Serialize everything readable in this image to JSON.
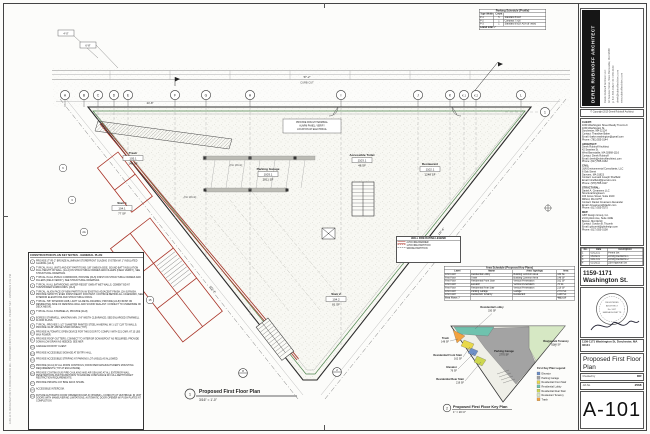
{
  "sheet": {
    "edge_note": "1159-1171 WASHINGTON ST, DORCHESTER MA - PROPOSED FIRST FLOOR PLAN - PERMIT SET - 10/05/2023 2:41 PM",
    "accent_red": "#a83226",
    "accent_green": "#3f7a3f"
  },
  "key_notes": {
    "title": "CONSTRUCTION PLAN KEY NOTES - GENERAL PLAN",
    "items": [
      {
        "n": "1",
        "text": "PROVIDE (TYP) 2\" BRONZE ALUMINUM STOREFRONT GLAZING SYSTEM W/ 1\" INSULATED GLAZING. [2A-3]"
      },
      {
        "n": "2",
        "text": "TYPICAL IN ALL UNITS AND EXT PARTITIONS: 5/8\" GWB EA SIDE, SOUND BATT INSULATION FULL HEIGHT OF WALL. [1A-4] ON STRUCTURAL FRAMES AND FILLERS (FIELD VERIFY), SEE STRUCTURAL DRAWINGS."
      },
      {
        "n": "3",
        "text": "TYPICAL IN ALL PUBLIC CORRIDORS, PROVIDE [3A-5] FINISH ON STRUCTURAL FRAMES AND FILLERS (FIELD VERIFY), SEE STRUCTURAL DRAWINGS."
      },
      {
        "n": "4",
        "text": "TYPICAL IN ALL BATHROOMS: WATER-RESIST GWB AT WET WALLS, CEMENT BD AT TUB/SHOWER SURROUNDS. [2A-6]"
      },
      {
        "n": "5",
        "text": "TYPICAL: ALIGN FACE OF NEW PARTITION W/ EXISTING ADJACENT FINISH. [2A-3] FINISH. PROVIDE SMOOTH, EVEN FINISH READY FOR PAINT. CONTINUE BEHIND ALL CASEWORK, SEE INTERIOR ELEVATIONS AND STRUCTURAL DWGS."
      },
      {
        "n": "6",
        "text": "TYPICAL: 5/8\" INTERIOR GWB, LIGHT GA METAL FRAMING; PROVIDE [2A-8] FINISH ON RESIDENTIAL SIDE OF DEMISING WALL AND SOUND SEALANT. CONNECT TO UNDERSIDE OF DECK ABOVE."
      },
      {
        "n": "7",
        "text": "TYPICAL IN ALL STAIRWELLS, PROVIDE [2A-8]."
      },
      {
        "n": "8",
        "text": "EGRESS STAIRWELL, MAINTAIN MIN. 3'-8\" WIDTH CLEARANCE; SEE ENLARGED STAIRWELL FLOOR PLANS."
      },
      {
        "n": "9",
        "text": "TYPICAL: PROVIDE 1-1/2\" DIAMETER PAINTED STEEL HANDRAIL W/ 1-1/2\" CLR TO WALLS; PROVIDE 34-36\" ABOVE STAIR NOSING (TYP)."
      },
      {
        "n": "10",
        "text": "PROVIDE AUTOMATIC OPEN DEVICE FOR THIS DOOR TO COMPLY WITH 521 CMR; AT 15 LBS MAX POWER."
      },
      {
        "n": "11",
        "text": "PROVIDE ROOF GUTTERS; CONNECT TO INTERIOR DOWNSPOUT AS REQUIRED; PROVIDE DOWN-LOW DRAIN AS NEEDED; SEE MEP."
      },
      {
        "n": "12",
        "text": "GARAGE DOOR BY CLIENT."
      },
      {
        "n": "13",
        "text": "PROVIDE ACCESSIBLE SIGNAGE AT ENTRY HALL."
      },
      {
        "n": "14",
        "text": "PROVIDE ACCESSIBLE STRIPING AT PARKING LOT (AISLE) AS ALLOWED."
      },
      {
        "n": "15",
        "text": "PROVIDE [10-11] AT ALL ROOM CONTROLS; ROOM PER MANUFACTURER'S MOUNTING REQUIREMENTS (TYP AT ENCLOSURE)."
      },
      {
        "n": "16",
        "text": "PROVIDE CONTINUOUS FIRE CAULKING AND AIR SEALING AT ALL EXTERIOR WALL PENETRATIONS AND TRANSITIONS TO ENSURE COMPLIANCE W/ FULL-DEPTH DRAFT RESTRICTION REQUIREMENTS."
      },
      {
        "n": "17",
        "text": "PROVIDE PRIVATE 4'x6' BIKE RACK SHAPE."
      },
      {
        "n": "18",
        "text": "ACCESSIBLE INTERCOM."
      },
      {
        "n": "19",
        "text": "FUTURE AUTOMATIC DOOR OPENER ROUGH-IN (POWER + CONDUIT) AT VESTIBULE; IN UNIT DOORS WITH MANEUVERING LIMITATIONS, AUTOMATIC DOOR OPENER W/ PUSH PLATES AT COMPLETION."
      }
    ]
  },
  "parking_schedule": {
    "title": "Parking Schedule (Profile)",
    "columns": [
      "Type Width",
      "Count",
      ""
    ],
    "rows": [
      [
        "P-1",
        "5",
        "Standard 8'x18'"
      ],
      [
        "P-2",
        "1",
        "Compact 7'x16'"
      ],
      [
        "P-3",
        "1",
        "Standard 8'x18' ADA (8' wide)"
      ]
    ],
    "footer": "Grand total: 7"
  },
  "grid": {
    "letters": [
      "A",
      "B",
      "C",
      "D",
      "E",
      "F",
      "G",
      "H",
      "I",
      "J",
      "K",
      "K.1",
      "K.2",
      "L"
    ],
    "row_bubble": "1"
  },
  "plan": {
    "street_label_dim": "57'-2\"",
    "street_label": "CURB CUT",
    "top_dim": "24'-8\"",
    "left_dim": "121'-4\"",
    "right_dim": "137'-6\"",
    "detail_dims": [
      "4'-0\"",
      "6'-8\""
    ],
    "keyed_bubbles": [
      "6",
      "3",
      "2A",
      "15"
    ],
    "no_work": "(No Work)",
    "note_box_lines": [
      "PROVIDE ROUGH TERMINAL",
      "ALARM PANEL; VERIFY",
      "LOCATION W/ ELECTRICAL"
    ],
    "rooms": [
      {
        "name": "Parking Garage",
        "number": "1003.1",
        "area": "2811 SF"
      },
      {
        "name": "Accessible Toilet",
        "number": "1103.1",
        "area": "48 SF"
      },
      {
        "name": "Restaurant",
        "number": "1102.1",
        "area": "1248 SF"
      },
      {
        "name": "Trash",
        "number": "105.1",
        "area": "148 SF"
      },
      {
        "name": "Stair 1",
        "number": "104.1",
        "area": "77 SF"
      },
      {
        "name": "Stair 2",
        "number": "104.2",
        "area": "81 SF"
      }
    ],
    "detail_markers": [
      "2",
      "8"
    ],
    "caption": {
      "num": "1",
      "title": "Proposed First Floor Plan",
      "scale": "3/16\" = 1'-0\""
    }
  },
  "wall_legend": {
    "title": "WALL FIRE RATING LEGEND",
    "rows": [
      {
        "symbol": "double-red",
        "label": "2-HR FIRE BARRIER"
      },
      {
        "symbol": "dash-red",
        "label": "1-HR FIRE PARTITION"
      },
      {
        "symbol": "dash-gray",
        "label": "SMOKE PARTITION"
      }
    ]
  },
  "area_schedule": {
    "title": "Area Schedule (Proposed Key Plans)",
    "columns": [
      "Level",
      "Name",
      "Area Typology",
      "Area"
    ],
    "rows": [
      [
        "First Floor",
        "Residential Lobby",
        "Building Common Area",
        "330 SF"
      ],
      [
        "First Floor",
        "Trash",
        "Building Common Area",
        "148 SF"
      ],
      [
        "First Floor",
        "Residential Front Stair",
        "Vertical Penetration",
        "162 SF"
      ],
      [
        "First Floor",
        "Elevator",
        "Vertical Penetration",
        "76 SF"
      ],
      [
        "First Floor",
        "Residential Rear Stair",
        "Vertical Penetration",
        "219 SF"
      ],
      [
        "First Floor",
        "Parking Garage",
        "Garage",
        "2770 SF"
      ],
      [
        "First Floor",
        "Restaurant Tenancy",
        "Restaurant",
        "1248 SF"
      ]
    ],
    "footer": [
      "First Floor: 7",
      "",
      "",
      "4953 SF"
    ]
  },
  "key_plan": {
    "labels": [
      {
        "name": "Residential Lobby",
        "area": "330 SF"
      },
      {
        "name": "Trash",
        "area": "148 SF"
      },
      {
        "name": "Residential Front Stair",
        "area": "162 SF"
      },
      {
        "name": "Elevator",
        "area": "76 SF"
      },
      {
        "name": "Residential Rear Stair",
        "area": "219 SF"
      },
      {
        "name": "Parking Garage",
        "area": "2770 SF"
      },
      {
        "name": "Restaurant Tenancy",
        "area": "1248 SF"
      }
    ],
    "legend": {
      "title": "First Key Plan Legend",
      "items": [
        {
          "label": "Elevator",
          "color": "#6d8fc7"
        },
        {
          "label": "Parking Garage",
          "color": "#a3a3a3"
        },
        {
          "label": "Residential Front Stair",
          "color": "#e8d84a"
        },
        {
          "label": "Residential Lobby",
          "color": "#6fc2ae"
        },
        {
          "label": "Residential Rear Stair",
          "color": "#cdd74f"
        },
        {
          "label": "Restaurant Tenancy",
          "color": "#d6e8c4"
        },
        {
          "label": "Trash",
          "color": "#f2a23f"
        }
      ]
    },
    "caption": {
      "num": "2",
      "title": "Proposed First Floor Key Plan",
      "scale": "1\" = 20'-0\""
    }
  },
  "titleblock": {
    "firm": {
      "name": "DEREK RUBINOFF ARCHITECT",
      "contact_lines": [
        "Derek Rubinoff Architect LLC",
        "42 Seaview Street, West Barnstable, MA 02668",
        "p: 617.555.0162  f: 617.555.0163",
        "derek@rubinoffarchitect.com",
        "www.rubinoffarchitect.com"
      ]
    },
    "copyright": "© Copyright 2019 Derek Rubinoff Architect",
    "consultants": [
      {
        "header": "CLIENT:",
        "lines": [
          "1159 Washington Street Realty Trust LLC",
          "1159 Washington St.",
          "Dorchester, MA 02124",
          "Contact: Thandiwe Baker",
          "Email: tbaker.washington@gmail.com",
          "Phone: (781) 555-0144"
        ]
      },
      {
        "header": "ARCHITECT:",
        "lines": [
          "Derek Rubinoff Architect",
          "42 Seaview St.",
          "West Barnstable, MA 02668-1116",
          "Contact: Derek Rubinoff",
          "Email: derek@rubinoffarchitect.com",
          "Phone: (617) 555-0162"
        ]
      },
      {
        "header": "CIVIL:",
        "lines": [
          "J&N Environmental Consultants, LLC",
          "8 Oak Street",
          "Danvers, MA 01923",
          "Contact: Leonard Joseph Sheffield",
          "Email: lsheffield@jnenviro.com",
          "Phone: (978) 555-0117"
        ]
      },
      {
        "header": "STRUCTURAL:",
        "lines": [
          "Daniel A. Creamens LLC",
          "Structural Engineers",
          "100 Grove Street, Suite 2100",
          "Milford, MA 01757",
          "Contact: Daniel Creamens Alexander",
          "Email: dcreamens@dacllc.com",
          "Phone: (617) 555-0175"
        ]
      },
      {
        "header": "MEP:",
        "lines": [
          "GBT Design Group, Inc.",
          "21 Drydock Ave, Suite 410E",
          "Boston, MA 02210",
          "Contact: Gordon B. Titcomb",
          "Email: gtitcomb@gbtdesign.com",
          "Phone: (617) 555-0108"
        ]
      }
    ],
    "revisions": {
      "columns": [
        "No.",
        "Date",
        "Description"
      ],
      "rows": [
        [
          "1",
          "03/12/21",
          "Permit Set"
        ],
        [
          "2",
          "06/04/21",
          "Zoning Revisions 1"
        ],
        [
          "3",
          "09/17/21",
          "Zoning Revisions 2"
        ],
        [
          "4",
          "01/26/22",
          "ZBA Approval Set"
        ],
        [
          "5",
          "05/05/23",
          "Permit Set"
        ]
      ]
    },
    "project_name": "1159-1171 Washington St.",
    "stamp_lines": [
      "REGISTERED",
      "ARCHITECT",
      "No. 9417",
      "MASSACHUSETTS"
    ],
    "project_address": "1159-1171 Washington St, Dorchester, MA 02124",
    "sheet_title": "Proposed First Floor Plan",
    "fields": [
      {
        "label": "Checked by",
        "value": "DR"
      },
      {
        "label": "Job No.",
        "value": "2568"
      }
    ],
    "sheet_number": "A-101"
  }
}
